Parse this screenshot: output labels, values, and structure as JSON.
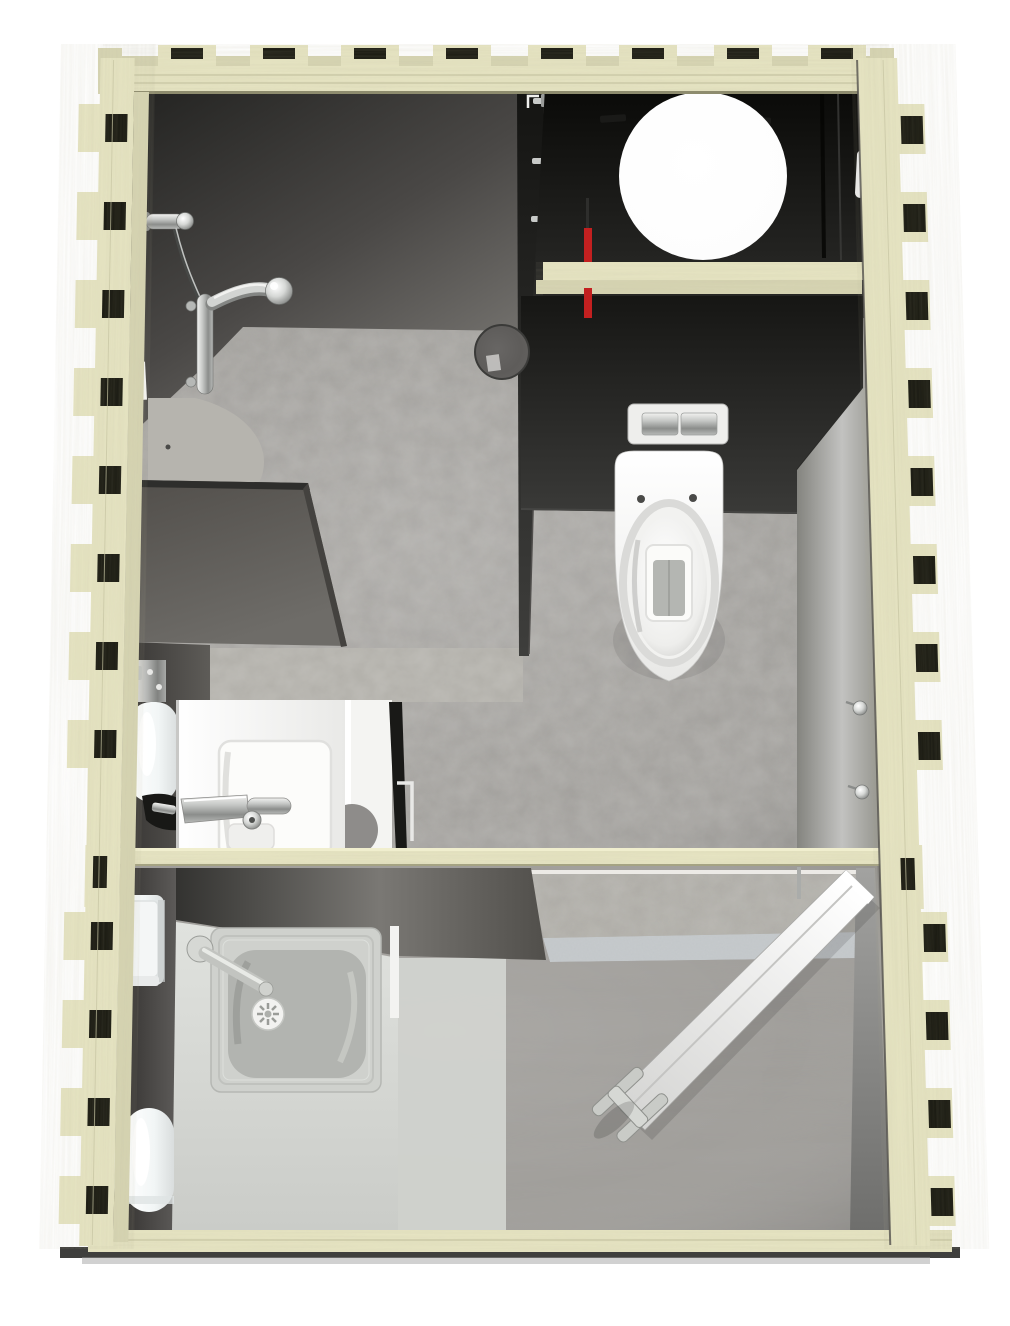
{
  "scene": {
    "type": "3d-floorplan-render",
    "description": "Top-down cutaway 3D rendering of a timber-framed sanitary building with a shower room, a WC room with water heater closet, and a utility room",
    "rooms": [
      "shower room",
      "wc room",
      "utility room"
    ],
    "fixtures": [
      "shower mixer with wall rail",
      "floor drain",
      "corner shower tray",
      "water heater tank",
      "red supply pipe",
      "wall-hung toilet",
      "flush plate",
      "coat hooks",
      "washbasin with mixer tap",
      "paper dispenser",
      "mirror panel",
      "counter with inset sink",
      "sink swivel tap",
      "soap dispenser",
      "waste bin",
      "leaning door panel with handle"
    ]
  },
  "colors": {
    "wood": "#e7e5c3",
    "wood_shade": "#d7d5b3",
    "wood_dark": "#bab893",
    "notch_dark": "#17170f",
    "ground_shadow": "#3f3f3d",
    "interior_black": "#0d0d0b",
    "wall_dark": "#2b2b29",
    "wall_mid": "#6e6c68",
    "charcoal": "#1e1e1c",
    "wall_light": "#c1c1bf",
    "floor_stone": "#a3a19d",
    "concrete_wall": "#b1afa9",
    "floor_wood": "#a09e9a",
    "floor_light": "#d4d6d2",
    "terrazzo": "#c7cbcd",
    "fixture_white": "#f8f8f6",
    "chrome_light": "#dcdedc",
    "chrome_dark": "#8e908e",
    "steel": "#cfd1cd",
    "basin_steel": "#b2b4b0",
    "red_pipe": "#c32020"
  }
}
